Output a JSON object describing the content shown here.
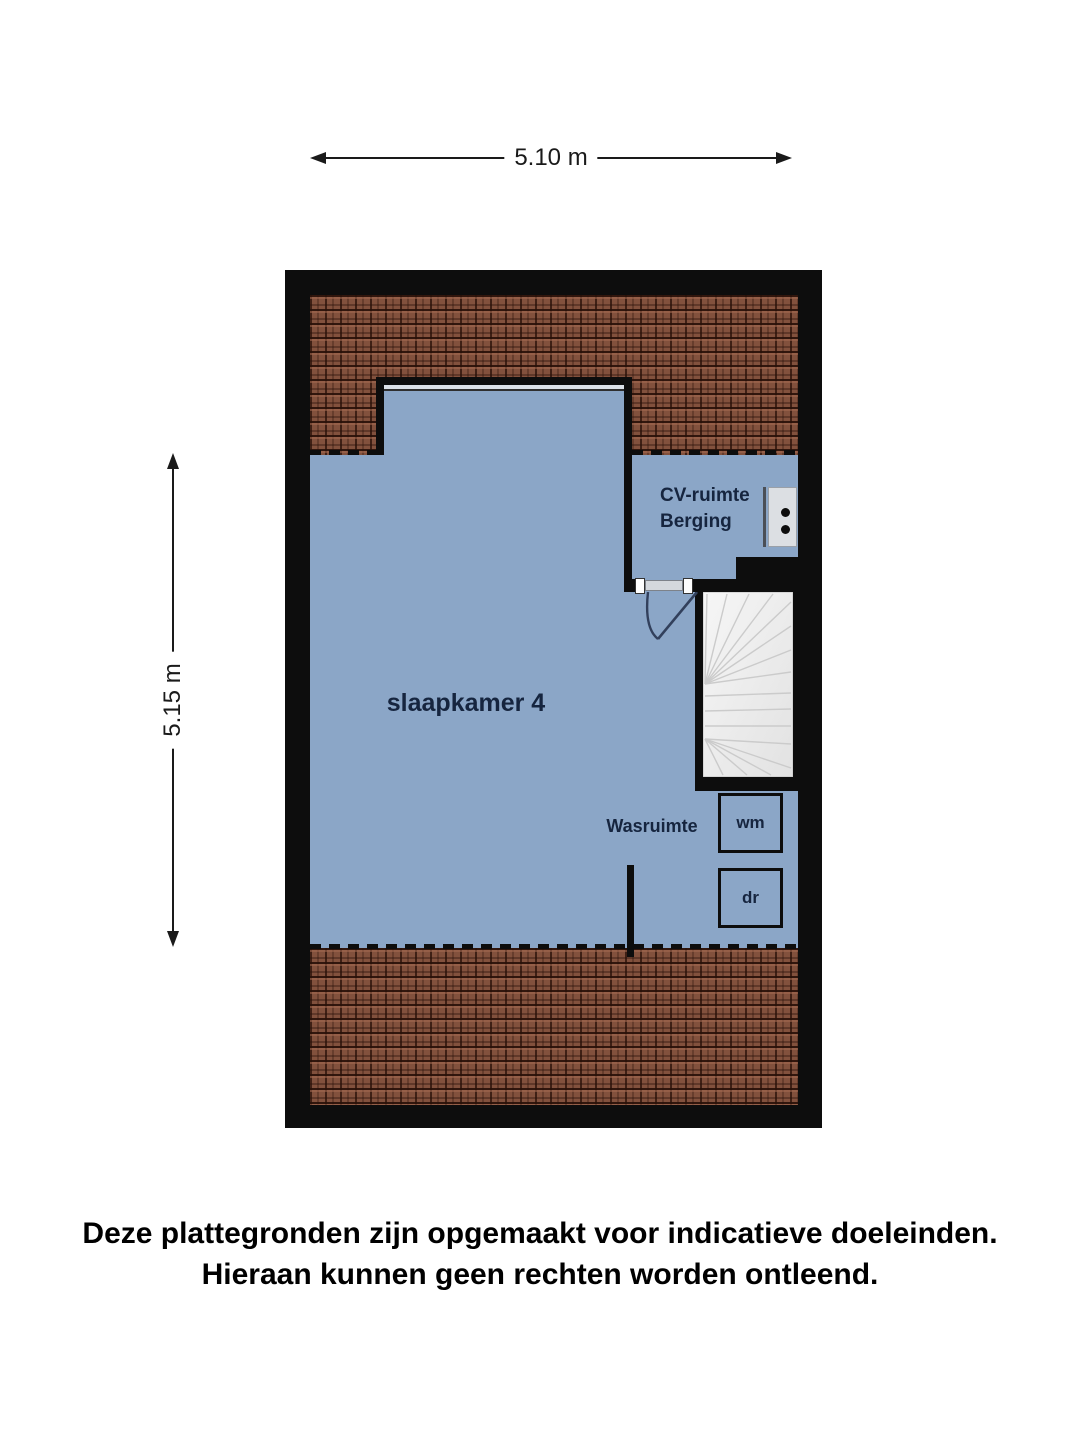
{
  "dimensions": {
    "top_label": "5.10 m",
    "left_label": "5.15 m"
  },
  "rooms": {
    "bedroom_label": "slaapkamer 4",
    "cv_room_line1": "CV-ruimte",
    "cv_room_line2": "Berging",
    "laundry_label": "Wasruimte",
    "washer_label": "wm",
    "dryer_label": "dr"
  },
  "disclaimer": {
    "line1": "Deze plattegronden zijn opgemaakt voor indicatieve doeleinden.",
    "line2": "Hieraan kunnen geen rechten worden ontleend."
  },
  "colors": {
    "wall": "#0d0d0d",
    "floor": "#8ba6c7",
    "roof_tile": "#82513d",
    "roof_groove": "#28100a",
    "label_navy": "#16253f",
    "stairs_light": "#f1f1f1",
    "door_swing": "#32405c"
  }
}
